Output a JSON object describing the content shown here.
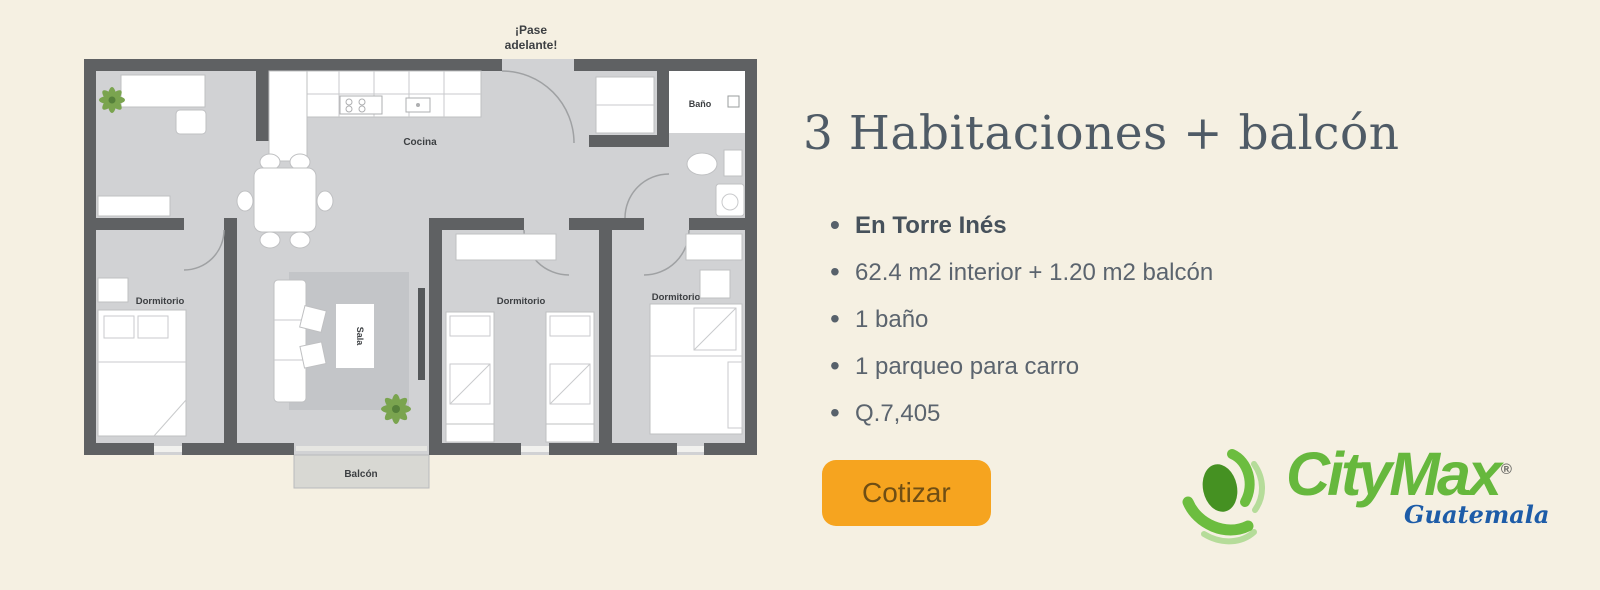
{
  "floor_plan": {
    "entry_note": {
      "line1": "¡Pase",
      "line2": "adelante!"
    },
    "labels": {
      "kitchen": "Cocina",
      "bathroom": "Baño",
      "bedroom1": "Dormitorio",
      "bedroom2": "Dormitorio",
      "bedroom3": "Dormitorio",
      "living": "Sala",
      "balcony": "Balcón"
    },
    "colors": {
      "wall": "#5f6163",
      "floor": "#d1d2d4",
      "plant": "#7aa44f"
    }
  },
  "listing": {
    "title": "3 Habitaciones + balcón",
    "features": [
      {
        "text": "En Torre Inés"
      },
      {
        "text": "62.4 m2 interior + 1.20 m2 balcón"
      },
      {
        "text": "1 baño"
      },
      {
        "text": "1 parqueo para carro"
      },
      {
        "text": "Q.7,405"
      }
    ],
    "cta": {
      "label": "Cotizar",
      "background": "#f6a41f"
    }
  },
  "brand": {
    "name": "CityMax",
    "registered_mark": "®",
    "subtitle": "Guatemala",
    "green": "#66b83d",
    "blue": "#1d5ca8"
  }
}
